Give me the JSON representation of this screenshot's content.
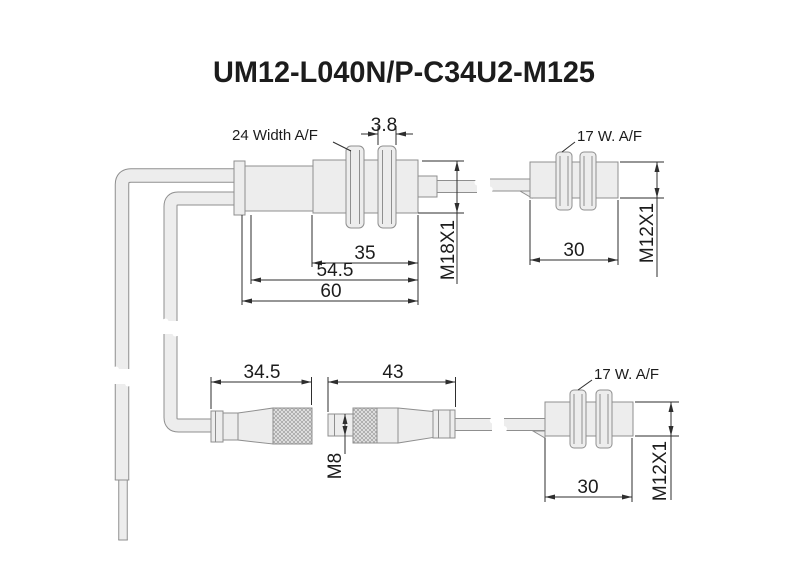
{
  "title": "UM12-L040N/P-C34U2-M125",
  "colors": {
    "background": "#ffffff",
    "part_fill": "#ededed",
    "part_stroke": "#8f8f8f",
    "dim_color": "#2e2e2e",
    "text_color": "#1c1c1c"
  },
  "views": {
    "m18_sensor": {
      "wrench_label": "24 Width A/F",
      "nut_width": "3.8",
      "thread_length": "35",
      "body_length": "54.5",
      "total_length": "60",
      "thread_spec": "M18X1"
    },
    "m12_sensor_top": {
      "wrench_label": "17 W. A/F",
      "body_length": "30",
      "thread_spec": "M12X1"
    },
    "m8_connector_female": {
      "length": "34.5"
    },
    "m8_connector_male": {
      "length": "43",
      "thread_spec": "M8"
    },
    "m12_sensor_bottom": {
      "wrench_label": "17 W. A/F",
      "body_length": "30",
      "thread_spec": "M12X1"
    }
  }
}
